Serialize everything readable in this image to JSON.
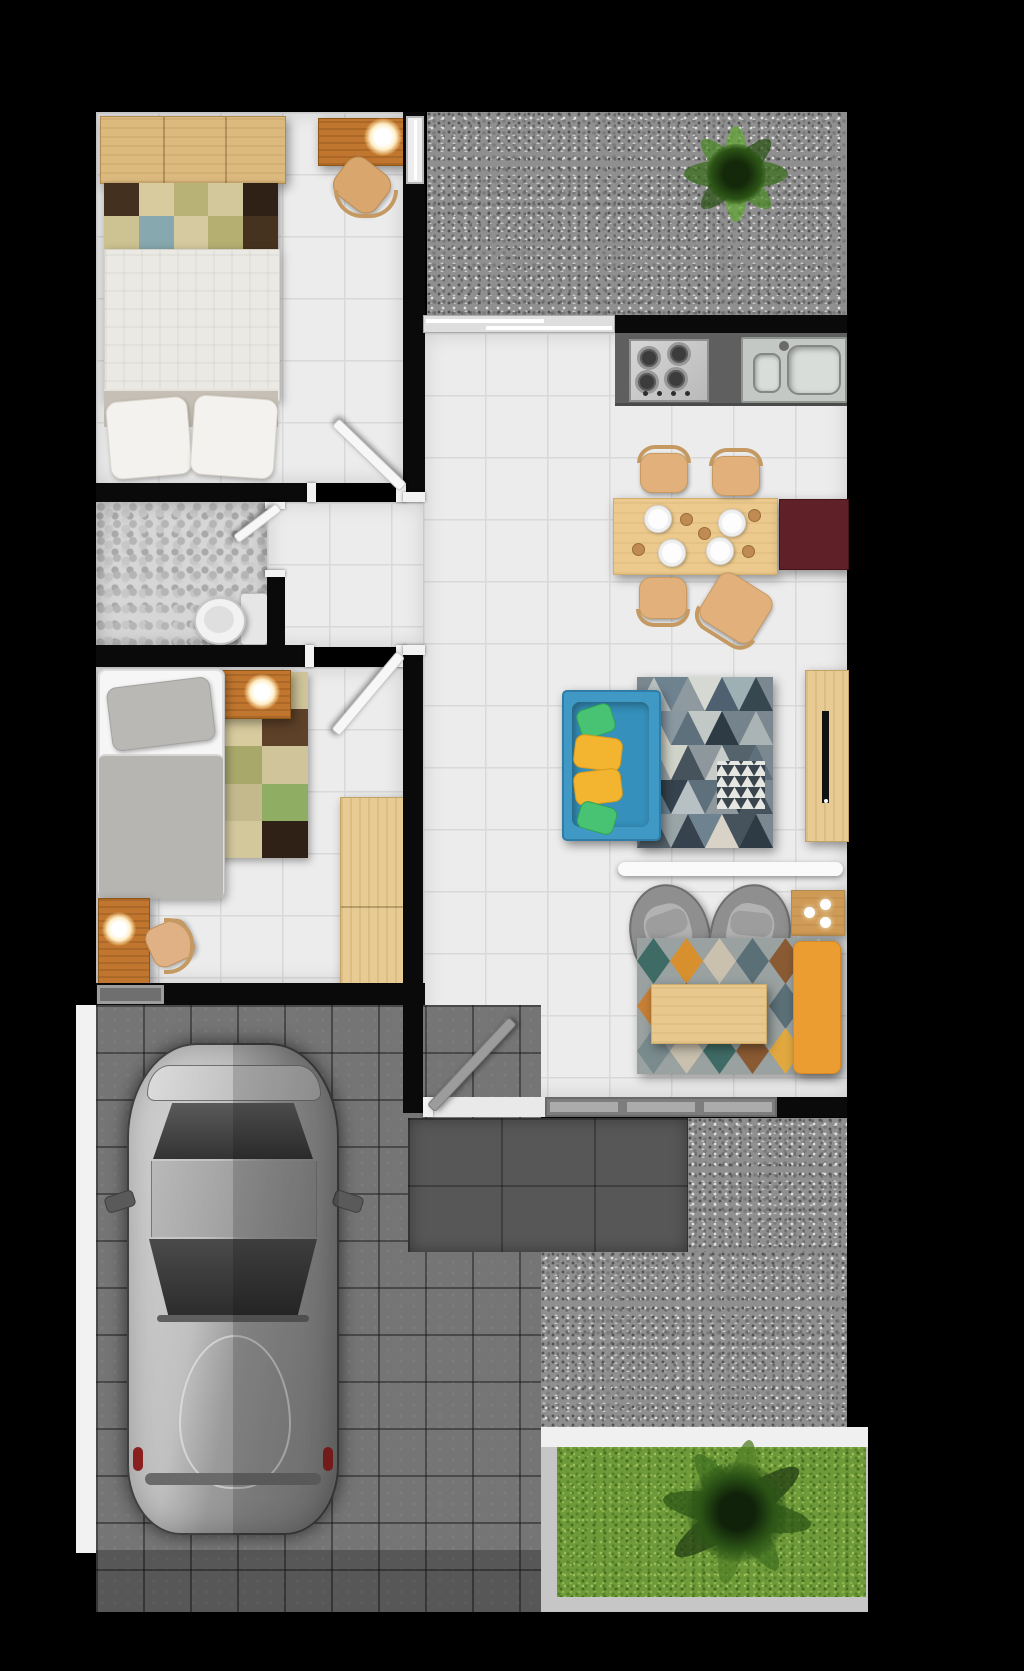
{
  "scene": {
    "kind": "architectural floor plan, top-down 3D render of a small house with carport and garden",
    "canvas": {
      "width_px": 1024,
      "height_px": 1671,
      "background": "#000000"
    }
  },
  "rooms": {
    "bedroom_main": {
      "label": "Main bedroom",
      "floor": "white ceramic tile",
      "items": [
        "wood dresser",
        "patchwork rug",
        "double bed with two pillows",
        "writing desk",
        "lit desk lamp",
        "wooden chair"
      ]
    },
    "bathroom": {
      "label": "Bathroom",
      "floor": "pebble mosaic",
      "items": [
        "toilet"
      ]
    },
    "bedroom_second": {
      "label": "Second bedroom",
      "floor": "white ceramic tile",
      "items": [
        "single bed with gray duvet",
        "nightstand",
        "lit table lamp",
        "patchwork rug",
        "study desk",
        "lit desk lamp",
        "wooden chair",
        "wardrobe"
      ]
    },
    "kitchen": {
      "label": "Kitchen",
      "items": [
        "dark counter",
        "4-burner gas hob",
        "stainless sink with drainboard"
      ]
    },
    "dining": {
      "label": "Dining area",
      "items": [
        "wooden dining table",
        "4 white plates",
        "4 wooden chairs",
        "burgundy sideboard"
      ]
    },
    "living": {
      "label": "Living room",
      "items": [
        "teal sofa",
        "green cushions",
        "yellow cushions",
        "triangle pattern rug",
        "TV sideboard",
        "flat TV"
      ]
    },
    "family": {
      "label": "Sitting area",
      "items": [
        "two gray armchairs",
        "diamond pattern rug",
        "wooden coffee table",
        "orange daybed",
        "side table with three lights",
        "white divider beam"
      ]
    },
    "corridor": {
      "label": "Hallway",
      "floor": "white ceramic tile",
      "items": []
    },
    "courtyard": {
      "label": "Gravel courtyard",
      "items": [
        "green shrub"
      ]
    },
    "carport": {
      "label": "Carport",
      "floor": "concrete pavers",
      "items": [
        "silver car seen from above",
        "white side walkway"
      ]
    },
    "porch": {
      "label": "Entrance terrace",
      "floor": "dark gray tiles",
      "items": []
    },
    "garden": {
      "label": "Back garden",
      "items": [
        "lawn",
        "leafy tree",
        "white path",
        "gray border"
      ]
    }
  },
  "openings": {
    "doors": [
      {
        "id": "bedroom-main-door",
        "type": "swing",
        "leaf_color": "#f7f7f7"
      },
      {
        "id": "bathroom-door",
        "type": "swing",
        "leaf_color": "#f7f7f7"
      },
      {
        "id": "bedroom-second-door",
        "type": "swing",
        "leaf_color": "#f7f7f7"
      },
      {
        "id": "entrance-door",
        "type": "swing",
        "leaf_color": "#9c9c9c"
      }
    ],
    "windows": [
      {
        "id": "courtyard-window",
        "between": "main bedroom and gravel courtyard"
      },
      {
        "id": "kitchen-window",
        "between": "gravel courtyard and kitchen"
      },
      {
        "id": "bedroom-second-vent",
        "between": "second bedroom and carport"
      },
      {
        "id": "living-window",
        "between": "living room and porch"
      }
    ]
  },
  "palettes": {
    "rug_bedroom_main": [
      "#43301f",
      "#d8cc9e",
      "#b9b277",
      "#d3c79c",
      "#2f2115",
      "#cdc291",
      "#86a8ae",
      "#d5caa0",
      "#b5af72",
      "#46331f"
    ],
    "rug_bedroom_second": [
      "#86a8ae",
      "#cfc49a",
      "#d8cc9e",
      "#5d4128",
      "#a9a86b",
      "#d0c49a",
      "#c4b98d",
      "#8fae63",
      "#d3c79c",
      "#2f2115"
    ],
    "rug_living_triangles": [
      "#b9c0bf",
      "#6e8290",
      "#8e9aa0",
      "#d6d8d2",
      "#4f6170",
      "#9fb0b5",
      "#37474f",
      "#d8d3c6",
      "#2e3b45",
      "#c7ccc9",
      "#55636d",
      "#e6e7e2"
    ],
    "rug_family_diamonds": [
      "#3f6b66",
      "#d88f2e",
      "#c9c0ae",
      "#5b6f77",
      "#8a5a33",
      "#adb6b8",
      "#2e4a52",
      "#c77f35",
      "#7a8b8e",
      "#e0a83f"
    ]
  },
  "colors": {
    "background": "#000000",
    "wall": "#0a0a0a",
    "tile_floor": "#ececec",
    "tile_grout": "#d9d9d9",
    "pebble_floor": "#d6d6d6",
    "paver_gray": "#757575",
    "porch_gray": "#575757",
    "gravel_gray": "#8f8f8f",
    "grass_green": "#6f9a39",
    "foliage_green": "#2c5416",
    "walkway_white": "#f2f2f2",
    "garden_border": "#c6c6c6",
    "wood_light": "#e7cb92",
    "wood_medium": "#dcba7e",
    "wood_desk": "#c0762f",
    "table_wood": "#ecca8e",
    "sofa_teal": "#3f99c4",
    "cushion_green": "#48c273",
    "cushion_yellow": "#f3b52f",
    "bench_orange": "#ec9d31",
    "sideboard_burgundy": "#5f2127",
    "counter_gray": "#5f5f5f",
    "stainless": "#c9cdc9",
    "armchair_gray": "#8f8f8f",
    "car_silver": "#b9b9b9",
    "door_leaf_white": "#f7f7f7",
    "door_leaf_gray": "#9c9c9c",
    "lamp_glow": "#ffeec7"
  },
  "counts": {
    "bedrooms": 2,
    "bathrooms": 1,
    "lit_lamps": 3,
    "dining_chairs": 4,
    "dining_plates": 4,
    "sofa_cushions": 4,
    "armchairs": 2,
    "swing_doors": 4,
    "windows": 4,
    "cars": 1,
    "trees": 1,
    "shrubs": 1
  }
}
